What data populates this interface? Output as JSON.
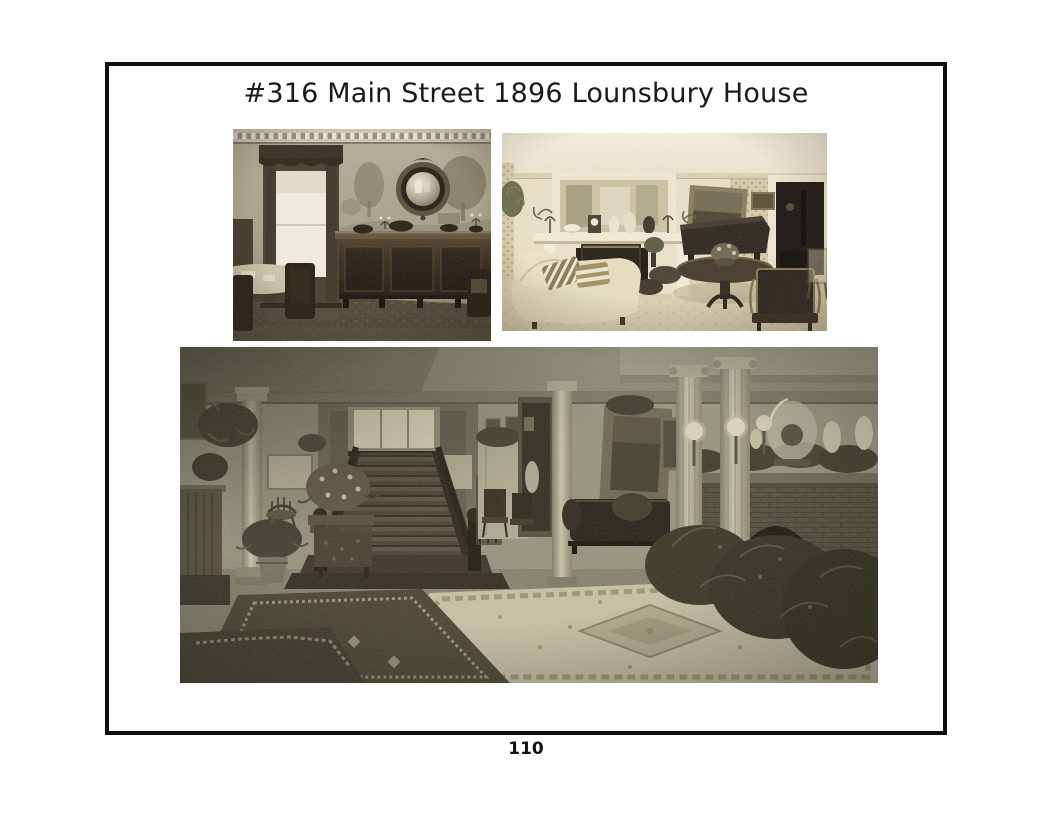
{
  "header": {
    "title": "#316 Main Street 1896 Lounsbury House"
  },
  "footer": {
    "page_number": "110"
  },
  "photos": [
    {
      "id": "dining-room",
      "alt": "Sepia photo: dining room with scenic mural wallpaper, tall curtained window, long mahogany sideboard with round convex mirror above, dining table and dark chairs on patterned carpet"
    },
    {
      "id": "parlor",
      "alt": "Sepia photo: parlor with white fireplace mantel crowded with vases and candelabra, mirror above, grand piano, round pedestal table, chaise with striped pillows, dark doorway at right"
    },
    {
      "id": "grand-hall",
      "alt": "Sepia photo: grand entrance hall with central dark staircase and landing window, fluted columns, brick fireplace with glass dome and vases on the mantel, ferns and potted plants, oriental rugs"
    }
  ],
  "colors": {
    "page_background": "#ffffff",
    "frame_border": "#0e0e0e",
    "title_text": "#1a1a1a",
    "photo1_tone": "#a6a088",
    "photo2_tone": "#e6dcc0",
    "photo3_tone": "#95927b"
  }
}
